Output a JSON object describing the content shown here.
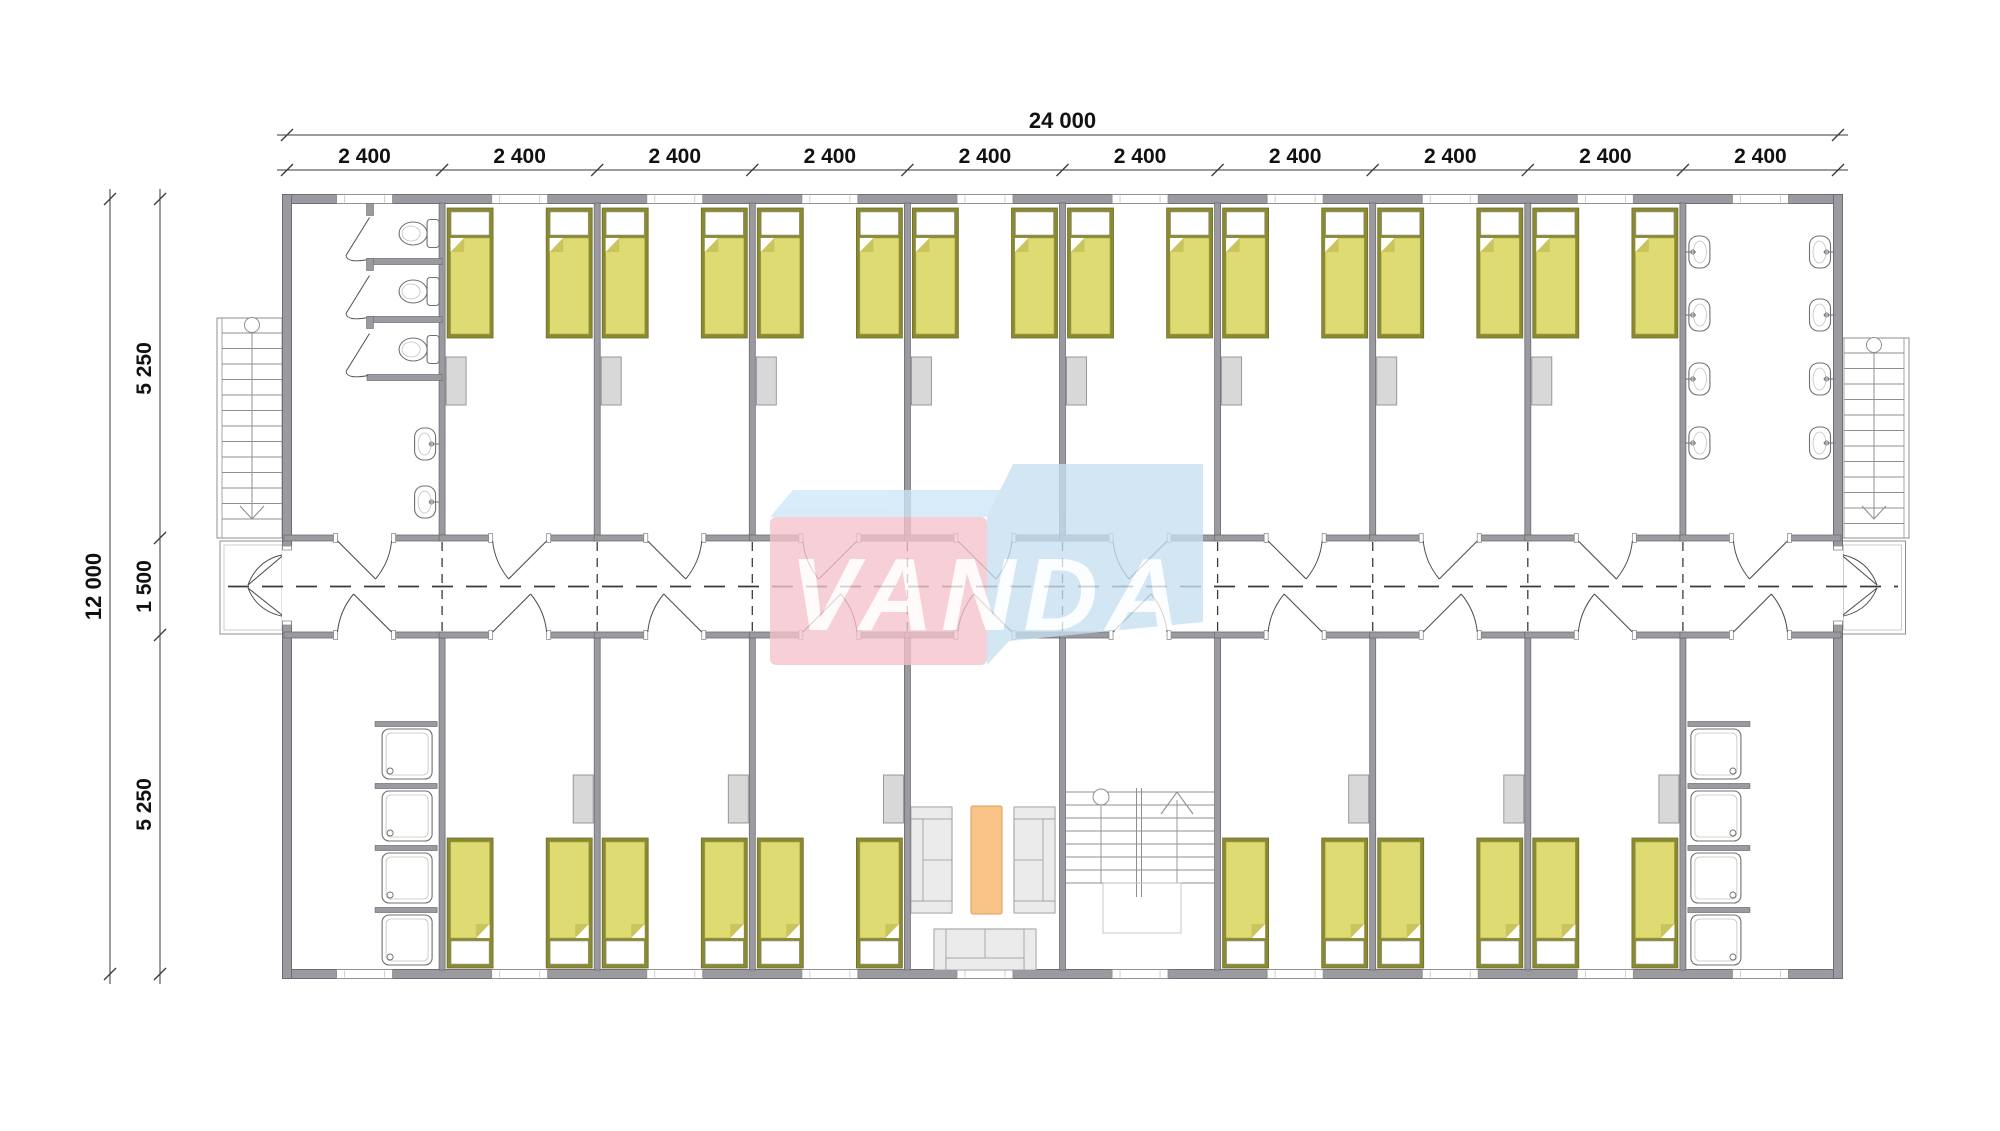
{
  "plan": {
    "watermark": {
      "text": "VANDA",
      "front_color": "#f5c2cb",
      "top_color": "#cde7f7",
      "side_color": "#c6dff1",
      "text_color": "#ffffff"
    },
    "dimensions": {
      "overall_width_label": "24 000",
      "module_width_label": "2 400",
      "module_count": 10,
      "overall_depth_label": "12 000",
      "front_band_label": "5 250",
      "corridor_label": "1 500",
      "back_band_label": "5 250"
    },
    "colors": {
      "background": "#ffffff",
      "wall_fill": "#9a9aa0",
      "wall_stroke": "#6d6d72",
      "line": "#4e4e4e",
      "thin_line": "#8f8f8f",
      "lighter_line": "#c2c2c2",
      "dim_line": "#3a3a3a",
      "text": "#111111",
      "bed_frame": "#8a8a33",
      "bed_frame_stroke": "#6f6f28",
      "bed_blanket": "#dedb73",
      "bed_blanket_stroke": "#a8a448",
      "bed_fold": "#c9c55c",
      "pillow": "#ffffff",
      "pillow_stroke": "#9a9a9a",
      "locker_fill": "#d8d8d8",
      "locker_stroke": "#8f8f8f",
      "fixture_stroke": "#707070",
      "fixture_fill": "#ffffff",
      "sofa_fill": "#ebebeb",
      "sofa_stroke": "#9a9a9a",
      "table_fill": "#f8c386",
      "table_stroke": "#dd9c55"
    },
    "modules": [
      {
        "id": 1,
        "top": "toilets",
        "bottom": "showers",
        "showers_wall": "right"
      },
      {
        "id": 2,
        "top": "bedroom",
        "bottom": "bedroom"
      },
      {
        "id": 3,
        "top": "bedroom",
        "bottom": "bedroom"
      },
      {
        "id": 4,
        "top": "bedroom",
        "bottom": "bedroom"
      },
      {
        "id": 5,
        "top": "bedroom",
        "bottom": "lounge"
      },
      {
        "id": 6,
        "top": "bedroom",
        "bottom": "stairs"
      },
      {
        "id": 7,
        "top": "bedroom",
        "bottom": "bedroom"
      },
      {
        "id": 8,
        "top": "bedroom",
        "bottom": "bedroom"
      },
      {
        "id": 9,
        "top": "bedroom",
        "bottom": "bedroom"
      },
      {
        "id": 10,
        "top": "washbasins",
        "bottom": "showers",
        "showers_wall": "left"
      }
    ],
    "fixture_counts": {
      "toilets": 3,
      "washbasins_toilet_room": 2,
      "washbasins_washroom": 8,
      "shower_trays_per_washroom": 4,
      "beds_per_bedroom": 2,
      "front_bedrooms": 8,
      "back_bedrooms": 6
    }
  }
}
